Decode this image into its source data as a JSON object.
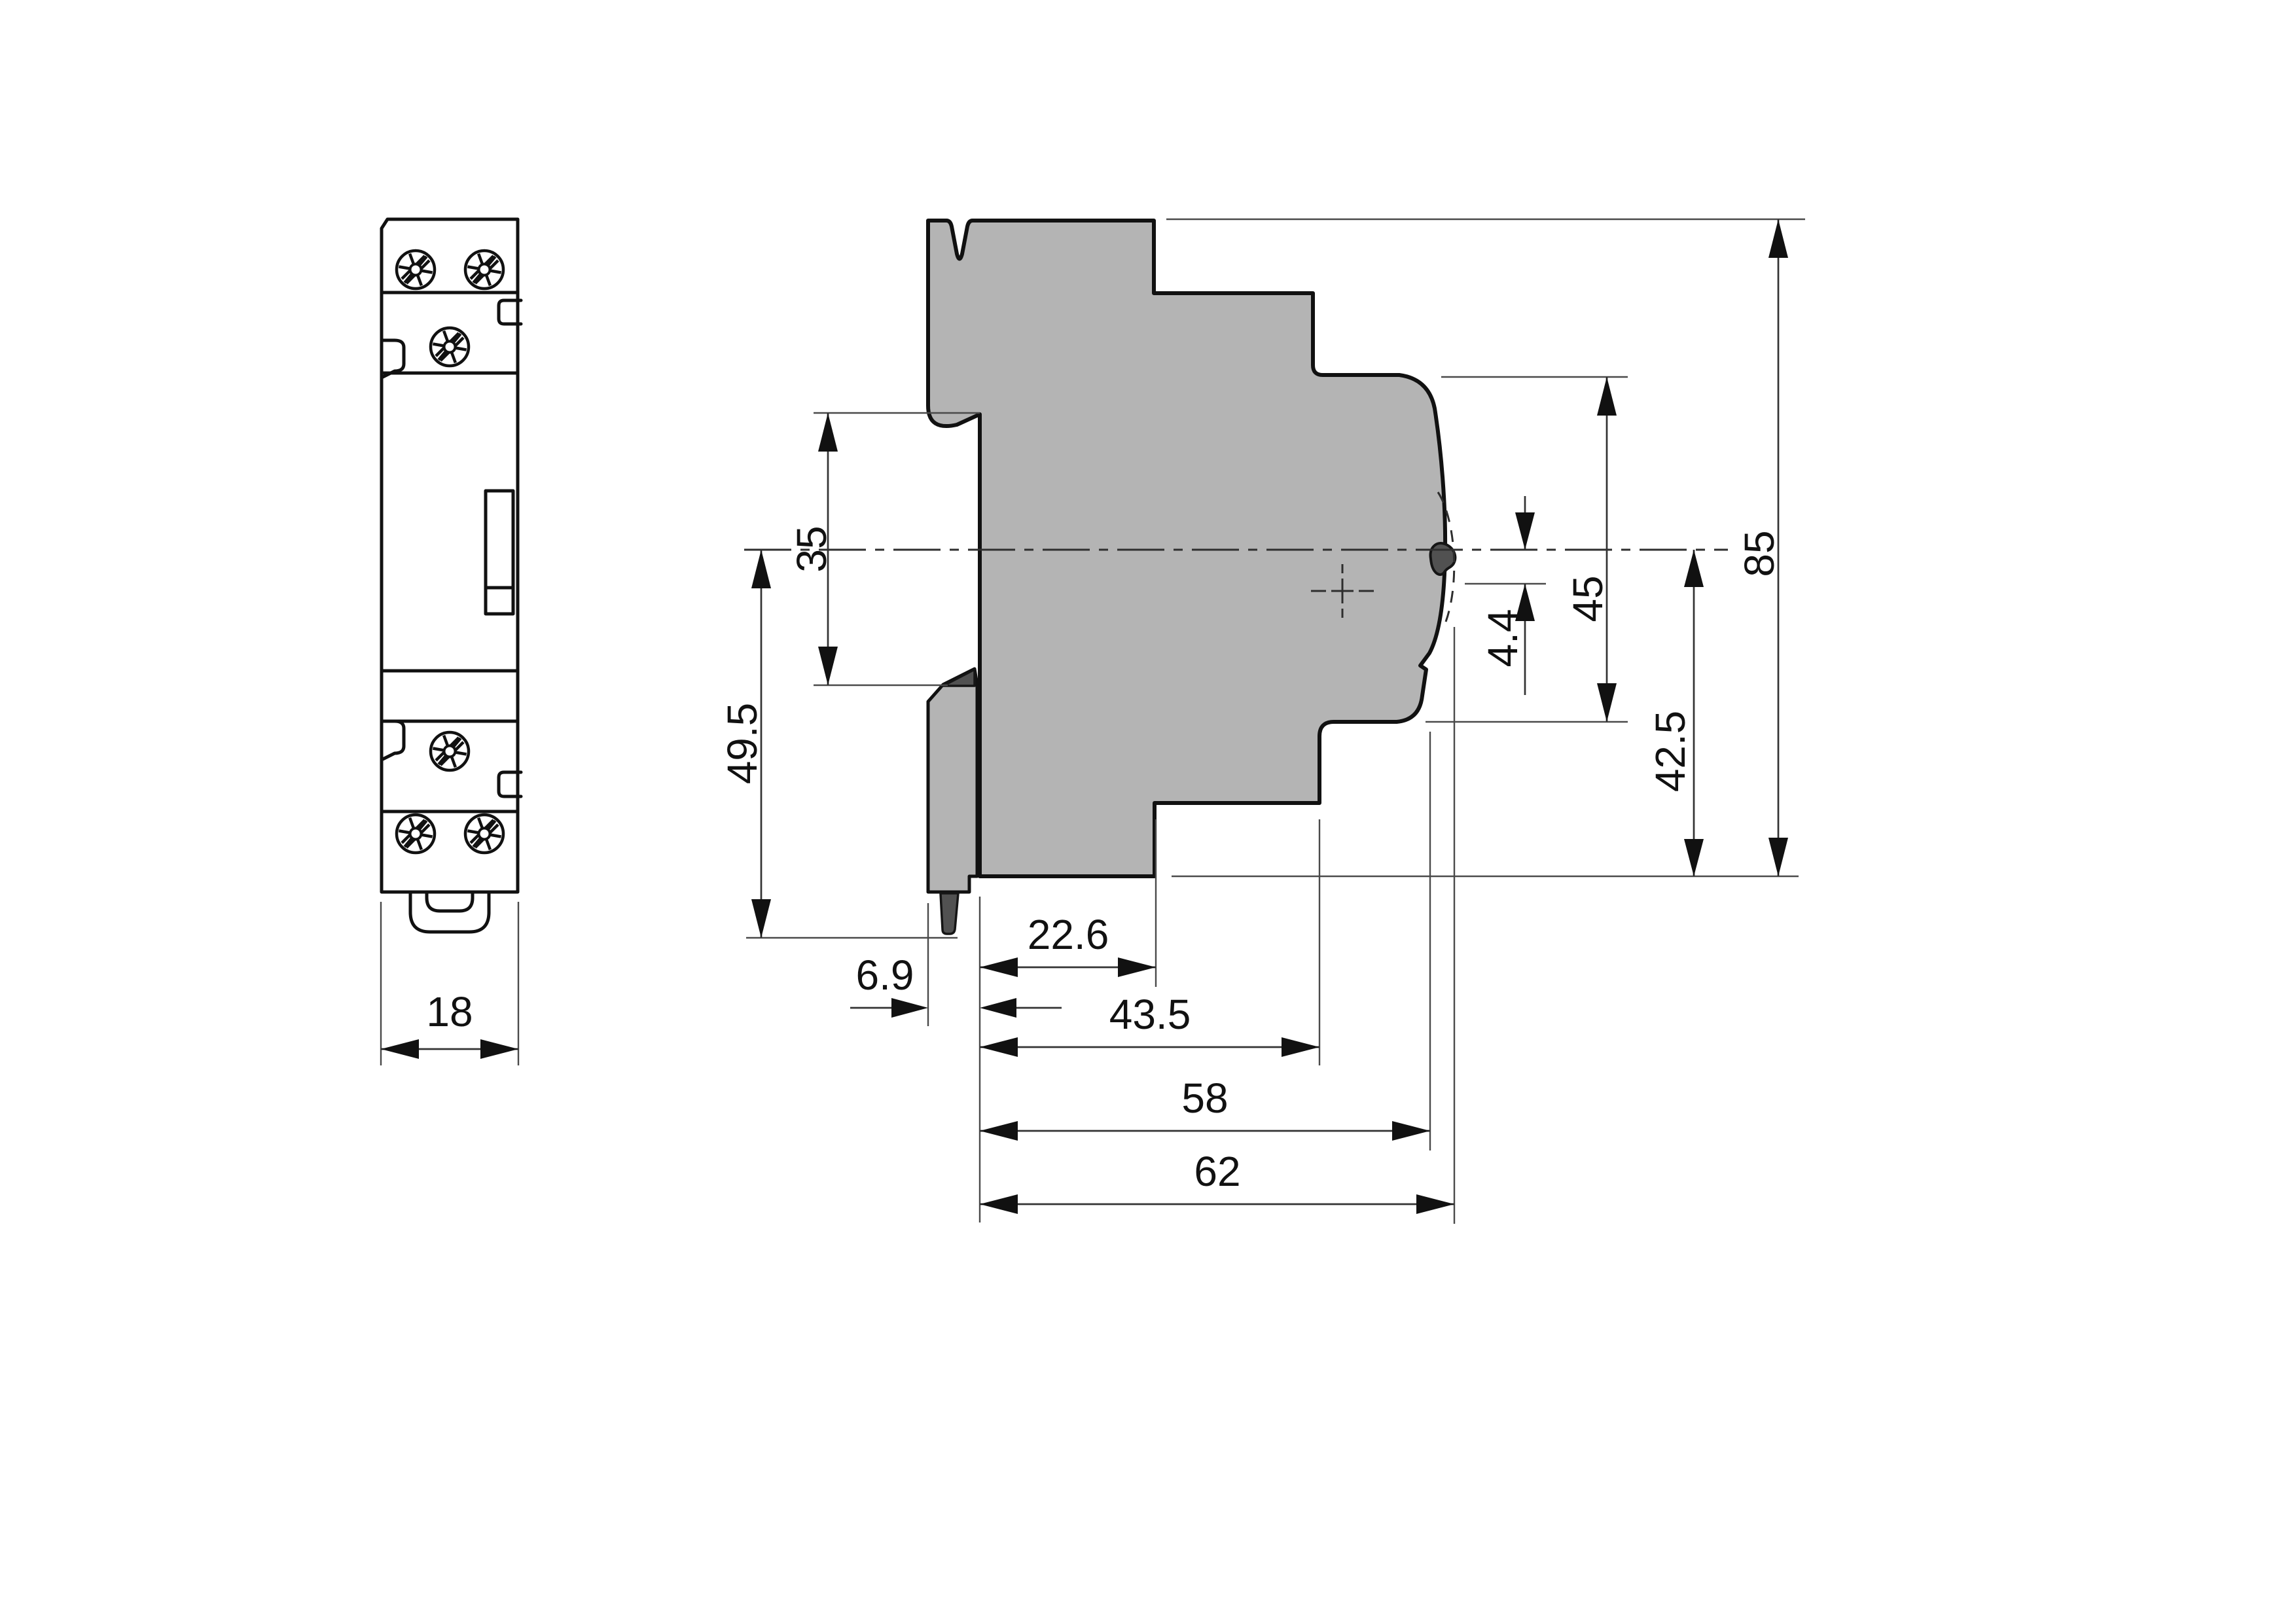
{
  "drawing_type": "technical-dimension-drawing",
  "colors": {
    "background": "#ffffff",
    "body_fill": "#b4b4b4",
    "outline": "#111111",
    "dimension_line": "#3a3a3a",
    "dark_part": "#515151"
  },
  "icons": {
    "screw": "pozidriv-screw-head-icon"
  },
  "dimensions": {
    "width": {
      "label": "18",
      "orientation": "horizontal",
      "view": "front"
    },
    "rail_notch": {
      "label": "35",
      "orientation": "vertical",
      "view": "side"
    },
    "center_to_foot": {
      "label": "49.5",
      "orientation": "vertical",
      "view": "side"
    },
    "clip_protrusion": {
      "label": "6.9",
      "orientation": "horizontal",
      "view": "side"
    },
    "rear_step_depth": {
      "label": "22.6",
      "orientation": "horizontal",
      "view": "side"
    },
    "mid_depth": {
      "label": "43.5",
      "orientation": "horizontal",
      "view": "side"
    },
    "body_depth": {
      "label": "58",
      "orientation": "horizontal",
      "view": "side"
    },
    "total_depth": {
      "label": "62",
      "orientation": "horizontal",
      "view": "side"
    },
    "toggle_offset": {
      "label": "4.4",
      "orientation": "vertical",
      "view": "side"
    },
    "front_height": {
      "label": "45",
      "orientation": "vertical",
      "view": "side"
    },
    "center_to_bottom": {
      "label": "42.5",
      "orientation": "vertical",
      "view": "side"
    },
    "total_height": {
      "label": "85",
      "orientation": "vertical",
      "view": "side"
    }
  }
}
